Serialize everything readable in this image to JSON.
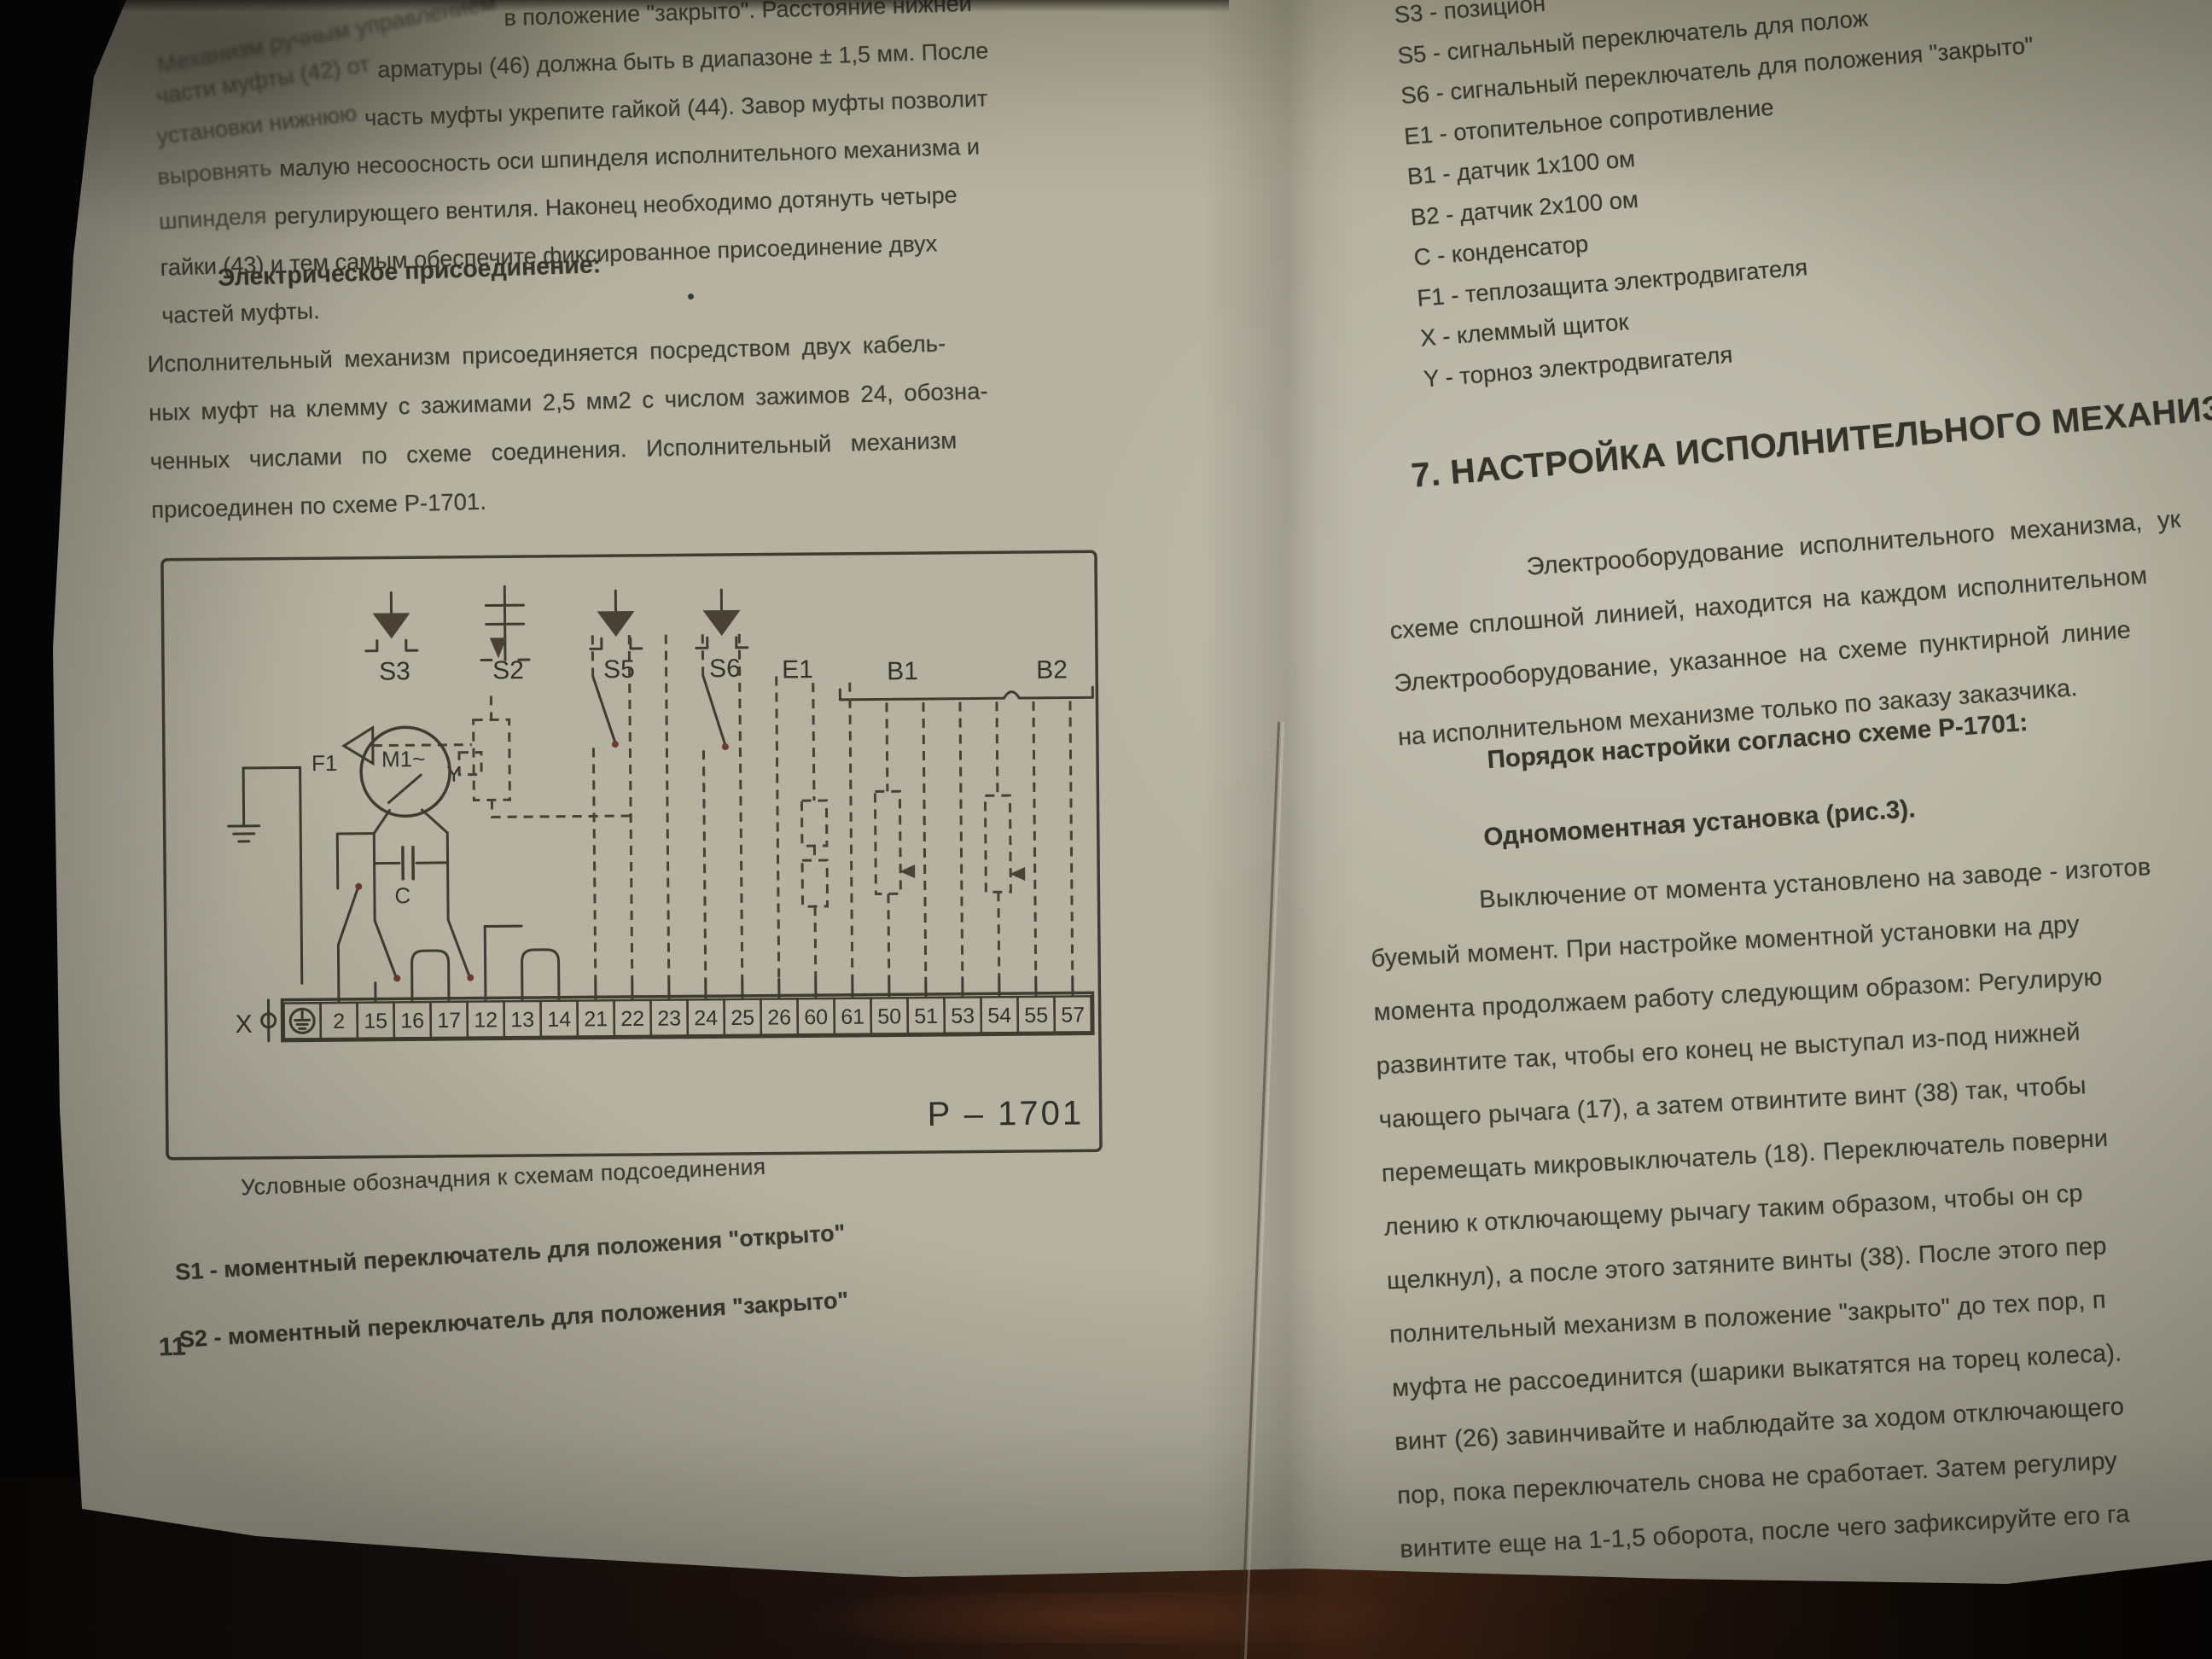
{
  "colors": {
    "paper": "#b5b2a1",
    "ink": "#3c3b31",
    "wood": "#3e2416",
    "accent_mark": "#6d3a2c"
  },
  "page_left": {
    "para1": {
      "l1a": "Механизм ручным управлением",
      "l1b": "в положение \"закрыто\". Расстояние нижней",
      "l2a": "части муфты (42) от",
      "l2b": "арматуры (46) должна быть в диапазоне ± 1,5 мм. После",
      "l3a": "установки нижнюю",
      "l3b": "часть муфты укрепите гайкой (44). Завор муфты позволит",
      "l4a": "выровнять",
      "l4b": "малую несоосность оси шпинделя исполнительного механизма и",
      "l5a": "шпинделя",
      "l5b": "регулирующего вентиля. Наконец необходимо дотянуть четыре",
      "l6": "гайки (43) и тем самым обеспечите фиксированное присоединение двух",
      "l7": "частей муфты."
    },
    "heading": "Электрическое присоединение:",
    "para2": {
      "l1": "Исполнительный механизм присоединяется посредством двух кабель-",
      "l2": "ных муфт на клемму с зажимами 2,5 мм2 с числом зажимов 24, обозна-",
      "l3": "ченных числами по схеме соединения. Исполнительный механизм",
      "l4": "присоединен по схеме Р-1701."
    },
    "diagram": {
      "labels": {
        "s3": "S3",
        "s2": "S2",
        "s5": "S5",
        "s6": "S6",
        "e1": "E1",
        "b1": "B1",
        "b2": "B2",
        "y": "Y",
        "m1": "M1~",
        "f1": "F1",
        "c": "C",
        "x": "X",
        "title": "P – 1701"
      },
      "terminals": [
        "2",
        "15",
        "16",
        "17",
        "12",
        "13",
        "14",
        "21",
        "22",
        "23",
        "24",
        "25",
        "26",
        "60",
        "61",
        "50",
        "51",
        "53",
        "54",
        "55",
        "57"
      ]
    },
    "caption": "Условные обозначдния к схемам подсоединения",
    "legend": {
      "s1": "S1 - моментный переключатель для положения \"открыто\"",
      "s2": "S2 - моментный переключатель для положения \"закрыто\""
    },
    "page_number": "11"
  },
  "page_right": {
    "legend": [
      "S3 -  позицион",
      "S5 - сигнальный переключатель для полож",
      "S6 - сигнальный переключатель для положения \"закрыто\"",
      "E1 - отопительное сопротивление",
      "B1 - датчик 1x100 ом",
      "B2 - датчик 2x100 ом",
      "C  - конденсатор",
      "F1 - теплозащита электродвигателя",
      "X  - клеммый щиток",
      "Y  - торноз электродвигателя"
    ],
    "section_heading": "7. НАСТРОЙКА ИСПОЛНИТЕЛЬНОГО МЕХАНИЗМА",
    "para1": [
      "Электрооборудование  исполнительного  механизма,  ук",
      "схеме сплошной линией, находится на каждом исполнительном",
      "Электрооборудование, указанное на схеме пунктирной линие",
      "на исполнительном механизме только по заказу заказчика."
    ],
    "subheading1": "Порядок настройки согласно схеме Р-1701:",
    "subheading2": "Одномоментная установка (рис.3).",
    "para2": [
      "Выключение от момента установлено на заводе - изготов",
      "буемый момент. При настройке моментной установки на дру",
      "момента продолжаем работу следующим образом: Регулирую",
      "развинтите так, чтобы его конец не выступал из-под нижней",
      "чающего рычага (17), а затем отвинтите винт (38) так, чтобы",
      "перемещать микровыключатель (18). Переключатель поверни",
      "лению к отключающему рычагу таким образом, чтобы он ср",
      "щелкнул), а после этого затяните винты (38). После этого пер",
      "полнительный механизм в положение \"закрыто\" до тех пор, п",
      "муфта не рассоединится (шарики выкатятся на торец колеса).",
      "винт (26) завинчивайте и наблюдайте за ходом отключающего",
      "пор, пока переключатель снова не сработает. Затем регулиру",
      "винтите еще на 1-1,5 оборота, после чего зафиксируйте его га"
    ]
  }
}
